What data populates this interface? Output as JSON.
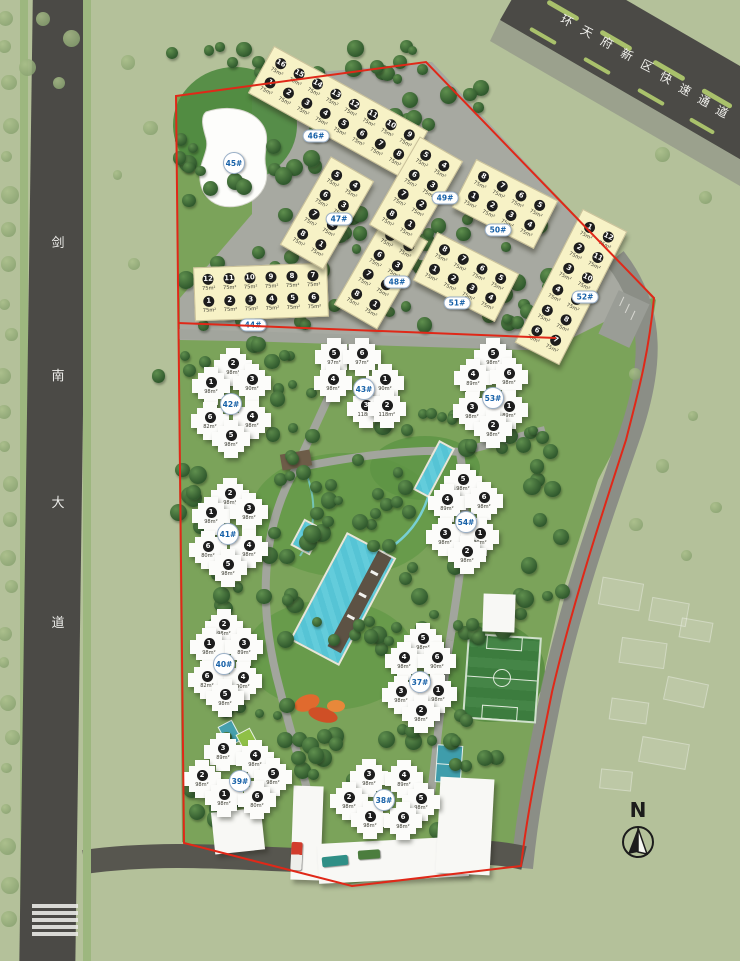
{
  "map_title": "residential community master plan",
  "roads": {
    "left_name_chars": [
      "剑",
      "南",
      "大",
      "道"
    ],
    "top_name_chars": [
      "环",
      "天",
      "府",
      "新",
      "区",
      "快",
      "速",
      "通",
      "道"
    ]
  },
  "compass": {
    "label": "N"
  },
  "colors": {
    "boundary_red": "#e02818",
    "road_dark": "#4b4a46",
    "paving_gray": "#a7a9a1",
    "site_green": "#7ba35a",
    "building_yellow": "#f7f2c6",
    "building_white": "#fcfcfa",
    "pool_blue": "#56c4d5",
    "label_blue": "#1761a8"
  },
  "unit_area_yellow": "75m²",
  "yellow_buildings": [
    {
      "id": "44#",
      "cx": 261,
      "cy": 292,
      "rot": -2,
      "label_dx": -8,
      "label_dy": 33,
      "rows": [
        [
          "12",
          "11",
          "10",
          "9",
          "8",
          "7"
        ],
        [
          "1",
          "2",
          "3",
          "4",
          "5",
          "6"
        ]
      ]
    },
    {
      "id": "46#",
      "cx": 338,
      "cy": 112,
      "rot": 29,
      "label_dx": -22,
      "label_dy": 24,
      "rows": [
        [
          "16",
          "15",
          "14",
          "13",
          "12",
          "11",
          "10",
          "9"
        ],
        [
          "1",
          "2",
          "3",
          "4",
          "5",
          "6",
          "7",
          "8"
        ]
      ]
    },
    {
      "id": "47#",
      "cx": 327,
      "cy": 213,
      "rot": 30,
      "label_dx": 12,
      "label_dy": 6,
      "rows": [
        [
          "5",
          "4"
        ],
        [
          "6",
          "3"
        ],
        [
          "7",
          "2"
        ],
        [
          "8",
          "1"
        ]
      ]
    },
    {
      "id": "48#",
      "cx": 381,
      "cy": 273,
      "rot": 30,
      "label_dx": 16,
      "label_dy": 9,
      "rows": [
        [
          "5",
          "4"
        ],
        [
          "6",
          "3"
        ],
        [
          "7",
          "2"
        ],
        [
          "8",
          "1"
        ]
      ]
    },
    {
      "id": "49#",
      "cx": 416,
      "cy": 193,
      "rot": 30,
      "label_dx": 29,
      "label_dy": 5,
      "rows": [
        [
          "5",
          "4"
        ],
        [
          "6",
          "3"
        ],
        [
          "7",
          "2"
        ],
        [
          "8",
          "1"
        ]
      ]
    },
    {
      "id": "50#",
      "cx": 505,
      "cy": 204,
      "rot": 27,
      "label_dx": -7,
      "label_dy": 26,
      "rows": [
        [
          "8",
          "7",
          "6",
          "5"
        ],
        [
          "1",
          "2",
          "3",
          "4"
        ]
      ]
    },
    {
      "id": "51#",
      "cx": 466,
      "cy": 277,
      "rot": 27,
      "label_dx": -9,
      "label_dy": 26,
      "rows": [
        [
          "8",
          "7",
          "6",
          "5"
        ],
        [
          "1",
          "2",
          "3",
          "4"
        ]
      ]
    },
    {
      "id": "52#",
      "cx": 571,
      "cy": 287,
      "rot": 27,
      "label_dx": 14,
      "label_dy": 10,
      "rows": [
        [
          "1",
          "12"
        ],
        [
          "2",
          "11"
        ],
        [
          "3",
          "10"
        ],
        [
          "4",
          "9"
        ],
        [
          "5",
          "8"
        ],
        [
          "6",
          "7"
        ]
      ]
    }
  ],
  "tower_buildings": [
    {
      "id": "42#",
      "cx": 231,
      "cy": 404,
      "units": [
        {
          "n": "2",
          "area": "98m²",
          "dx": 2,
          "dy": -37
        },
        {
          "n": "1",
          "area": "98m²",
          "dx": -20,
          "dy": -18
        },
        {
          "n": "3",
          "area": "90m²",
          "dx": 21,
          "dy": -21
        },
        {
          "n": "6",
          "area": "82m²",
          "dx": -21,
          "dy": 17
        },
        {
          "n": "4",
          "area": "98m²",
          "dx": 21,
          "dy": 16
        },
        {
          "n": "5",
          "area": "98m²",
          "dx": 0,
          "dy": 35
        }
      ]
    },
    {
      "id": "43#",
      "cx": 364,
      "cy": 389,
      "units": [
        {
          "n": "5",
          "area": "97m²",
          "dx": -30,
          "dy": -32
        },
        {
          "n": "6",
          "area": "97m²",
          "dx": -2,
          "dy": -32
        },
        {
          "n": "4",
          "area": "98m²",
          "dx": -31,
          "dy": -6
        },
        {
          "n": "1",
          "area": "90m²",
          "dx": 21,
          "dy": -6
        },
        {
          "n": "3",
          "area": "118m²",
          "dx": 2,
          "dy": 20
        },
        {
          "n": "2",
          "area": "118m²",
          "dx": 23,
          "dy": 20
        }
      ]
    },
    {
      "id": "53#",
      "cx": 493,
      "cy": 398,
      "units": [
        {
          "n": "5",
          "area": "98m²",
          "dx": 0,
          "dy": -41
        },
        {
          "n": "4",
          "area": "89m²",
          "dx": -20,
          "dy": -20
        },
        {
          "n": "6",
          "area": "98m²",
          "dx": 16,
          "dy": -21
        },
        {
          "n": "3",
          "area": "98m²",
          "dx": -21,
          "dy": 13
        },
        {
          "n": "1",
          "area": "89m²",
          "dx": 16,
          "dy": 12
        },
        {
          "n": "2",
          "area": "98m²",
          "dx": 0,
          "dy": 31
        }
      ]
    },
    {
      "id": "41#",
      "cx": 228,
      "cy": 534,
      "units": [
        {
          "n": "2",
          "area": "98m²",
          "dx": 2,
          "dy": -37
        },
        {
          "n": "1",
          "area": "98m²",
          "dx": -17,
          "dy": -18
        },
        {
          "n": "3",
          "area": "98m²",
          "dx": 21,
          "dy": -22
        },
        {
          "n": "6",
          "area": "80m²",
          "dx": -20,
          "dy": 16
        },
        {
          "n": "4",
          "area": "98m²",
          "dx": 21,
          "dy": 15
        },
        {
          "n": "5",
          "area": "98m²",
          "dx": 0,
          "dy": 34
        }
      ]
    },
    {
      "id": "54#",
      "cx": 466,
      "cy": 522,
      "units": [
        {
          "n": "5",
          "area": "98m²",
          "dx": -3,
          "dy": -39
        },
        {
          "n": "4",
          "area": "89m²",
          "dx": -19,
          "dy": -19
        },
        {
          "n": "6",
          "area": "98m²",
          "dx": 18,
          "dy": -21
        },
        {
          "n": "3",
          "area": "98m²",
          "dx": -21,
          "dy": 15
        },
        {
          "n": "1",
          "area": "90m²",
          "dx": 14,
          "dy": 15
        },
        {
          "n": "2",
          "area": "98m²",
          "dx": 1,
          "dy": 33
        }
      ]
    },
    {
      "id": "40#",
      "cx": 224,
      "cy": 664,
      "units": [
        {
          "n": "2",
          "area": "98m²",
          "dx": 0,
          "dy": -36
        },
        {
          "n": "1",
          "area": "98m²",
          "dx": -15,
          "dy": -17
        },
        {
          "n": "3",
          "area": "89m²",
          "dx": 20,
          "dy": -17
        },
        {
          "n": "6",
          "area": "82m²",
          "dx": -17,
          "dy": 16
        },
        {
          "n": "4",
          "area": "90m²",
          "dx": 19,
          "dy": 17
        },
        {
          "n": "5",
          "area": "98m²",
          "dx": 1,
          "dy": 34
        }
      ]
    },
    {
      "id": "37#",
      "cx": 420,
      "cy": 682,
      "units": [
        {
          "n": "5",
          "area": "98m²",
          "dx": 3,
          "dy": -40
        },
        {
          "n": "4",
          "area": "98m²",
          "dx": -16,
          "dy": -21
        },
        {
          "n": "6",
          "area": "90m²",
          "dx": 17,
          "dy": -21
        },
        {
          "n": "3",
          "area": "98m²",
          "dx": -19,
          "dy": 13
        },
        {
          "n": "1",
          "area": "98m²",
          "dx": 18,
          "dy": 12
        },
        {
          "n": "2",
          "area": "98m²",
          "dx": 1,
          "dy": 32
        }
      ]
    },
    {
      "id": "39#",
      "cx": 240,
      "cy": 781,
      "units": [
        {
          "n": "3",
          "area": "89m²",
          "dx": -17,
          "dy": -29
        },
        {
          "n": "4",
          "area": "98m²",
          "dx": 15,
          "dy": -22
        },
        {
          "n": "2",
          "area": "98m²",
          "dx": -38,
          "dy": -2
        },
        {
          "n": "5",
          "area": "98m²",
          "dx": 33,
          "dy": -4
        },
        {
          "n": "1",
          "area": "98m²",
          "dx": -16,
          "dy": 17
        },
        {
          "n": "6",
          "area": "80m²",
          "dx": 17,
          "dy": 19
        }
      ]
    },
    {
      "id": "38#",
      "cx": 384,
      "cy": 800,
      "units": [
        {
          "n": "3",
          "area": "98m²",
          "dx": -15,
          "dy": -22
        },
        {
          "n": "4",
          "area": "89m²",
          "dx": 20,
          "dy": -21
        },
        {
          "n": "2",
          "area": "98m²",
          "dx": -35,
          "dy": 1
        },
        {
          "n": "5",
          "area": "98m²",
          "dx": 37,
          "dy": 2
        },
        {
          "n": "1",
          "area": "98m²",
          "dx": -14,
          "dy": 20
        },
        {
          "n": "6",
          "area": "98m²",
          "dx": 19,
          "dy": 21
        }
      ]
    }
  ],
  "special_buildings": [
    {
      "id": "45#",
      "cx": 234,
      "cy": 163
    }
  ]
}
